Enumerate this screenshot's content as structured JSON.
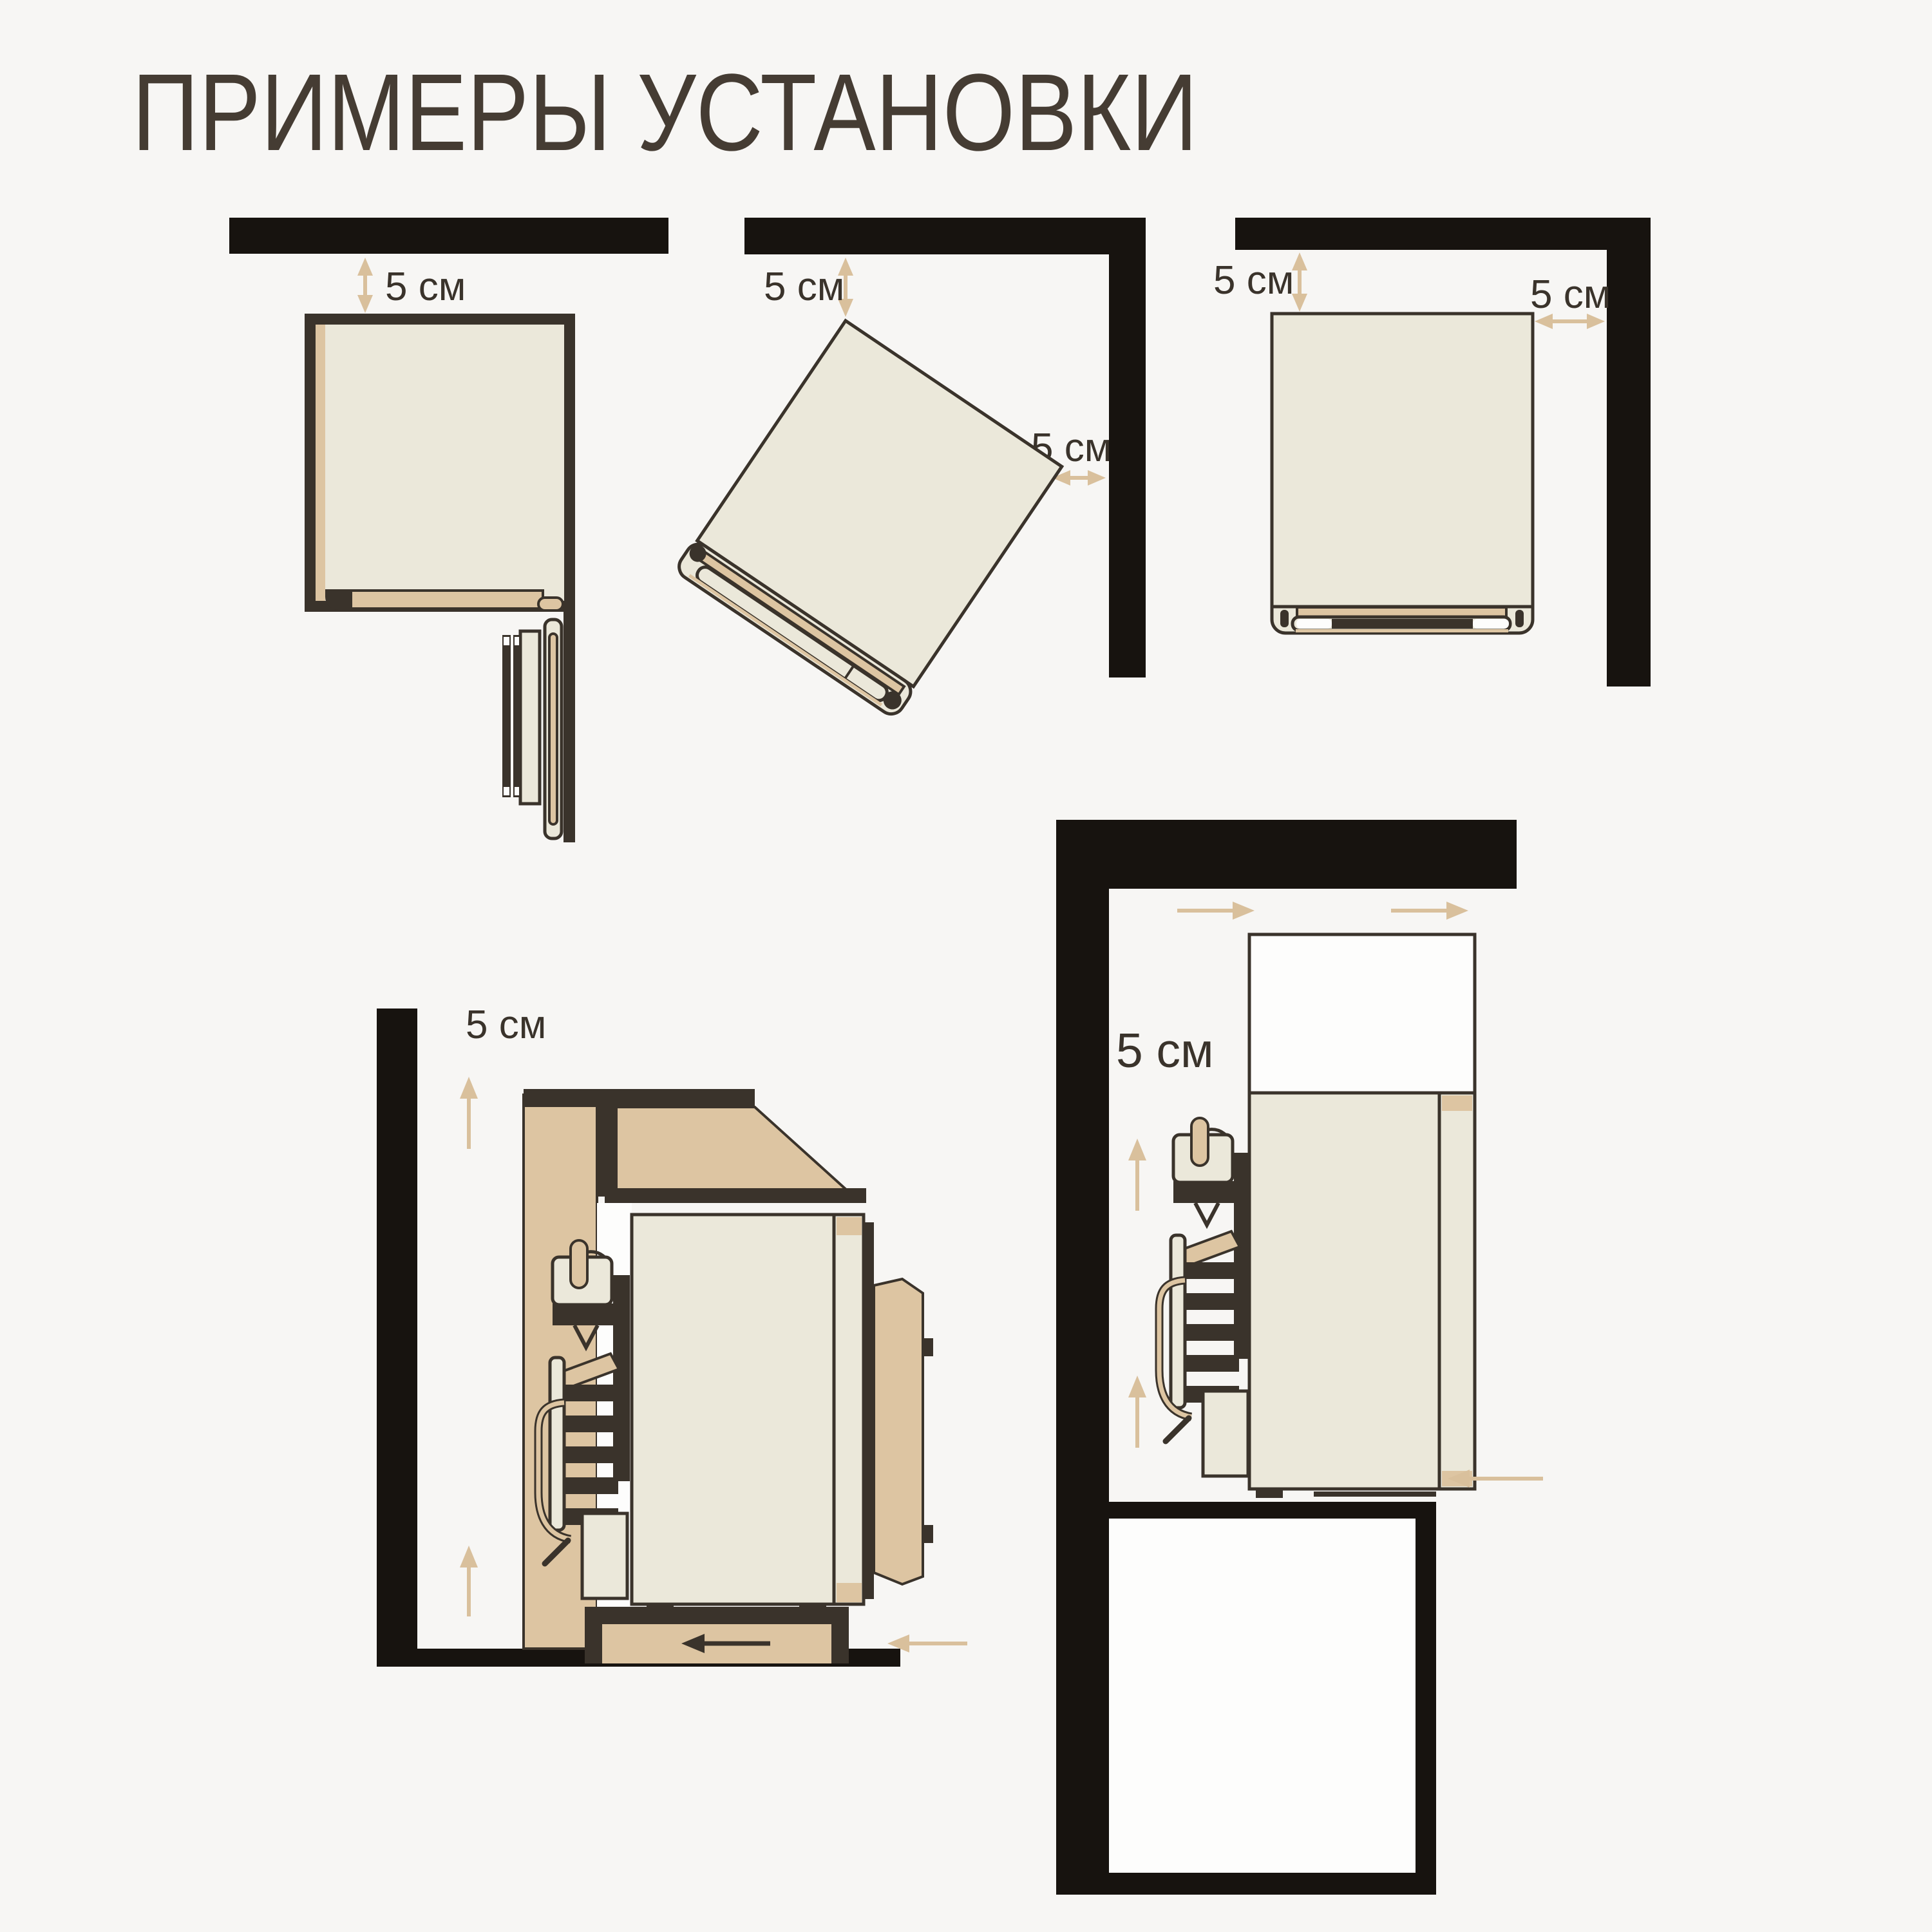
{
  "title": {
    "text": "ПРИМЕРЫ УСТАНОВКИ"
  },
  "clearance_value": "5 см",
  "diagrams": {
    "straight_wall_top_view": {
      "labels": {
        "top_gap": "5 см"
      }
    },
    "corner_tilted_top_view": {
      "labels": {
        "top_gap": "5 см",
        "side_gap": "5 см"
      }
    },
    "corner_straight_top_view": {
      "labels": {
        "top_gap": "5 см",
        "side_gap": "5 см"
      }
    },
    "cabinet_side_view": {
      "labels": {
        "wall_gap": "5 см"
      }
    },
    "built_in_column_view": {
      "labels": {
        "wall_gap": "5 см"
      }
    }
  },
  "colors": {
    "bg": "#f7f6f4",
    "wall": "#17130f",
    "ink": "#3a332b",
    "cream": "#ebe8da",
    "tan": "#ddc5a2",
    "arrow": "#d9c09c",
    "paper": "#fdfdfc",
    "title": "#453c33"
  }
}
